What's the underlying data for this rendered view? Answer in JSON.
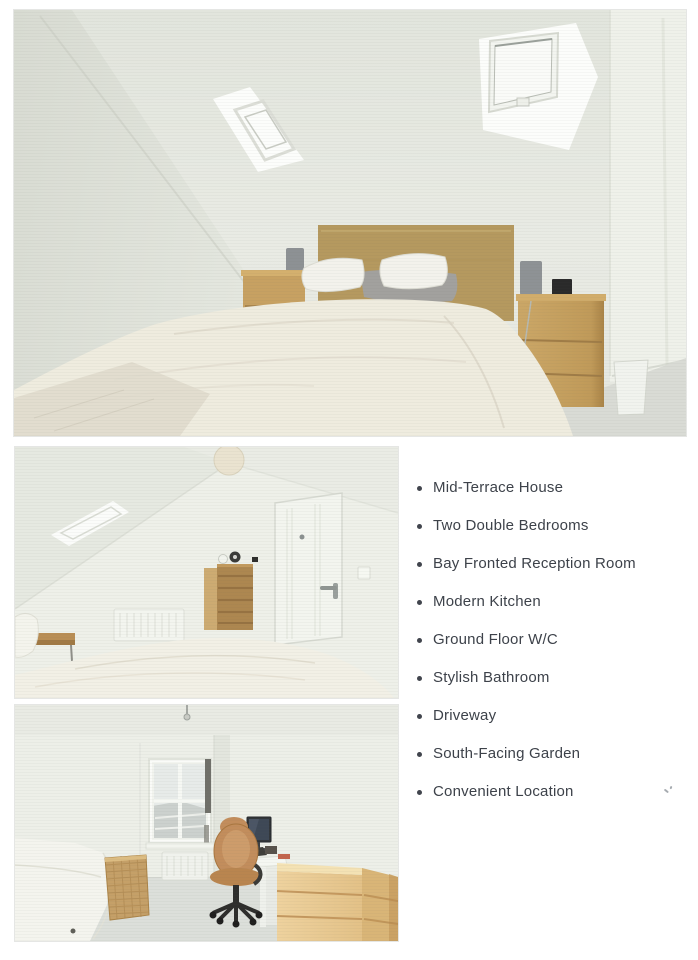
{
  "features": {
    "items": [
      "Mid-Terrace House",
      "Two Double Bedrooms",
      "Bay Fronted Reception Room",
      "Modern Kitchen",
      "Ground Floor W/C",
      "Stylish Bathroom",
      "Driveway",
      "South-Facing Garden",
      "Convenient Location"
    ],
    "bullet_color": "#41454d",
    "text_color": "#3d424a"
  },
  "photos": [
    {
      "name": "photo-attic-bedroom-main",
      "description": "Attic bedroom with two skylights, double bed with wooden headboard and two bedside chests"
    },
    {
      "name": "photo-attic-bedroom-door",
      "description": "Attic bedroom with skylight, ceiling lamp, tall chest of drawers, radiator and white door"
    },
    {
      "name": "photo-bedroom-desk",
      "description": "Bedroom with window, bed, wicker basket, desk with monitor, office chair and chest of drawers"
    }
  ],
  "colors": {
    "page_background": "#ffffff",
    "wall_tone": "#e9ebe4",
    "wood_tone": "#b5995f",
    "duvet_tone": "#efecdf",
    "carpet_tone": "#d9dbd5",
    "chair_tone": "#c28d5c"
  }
}
